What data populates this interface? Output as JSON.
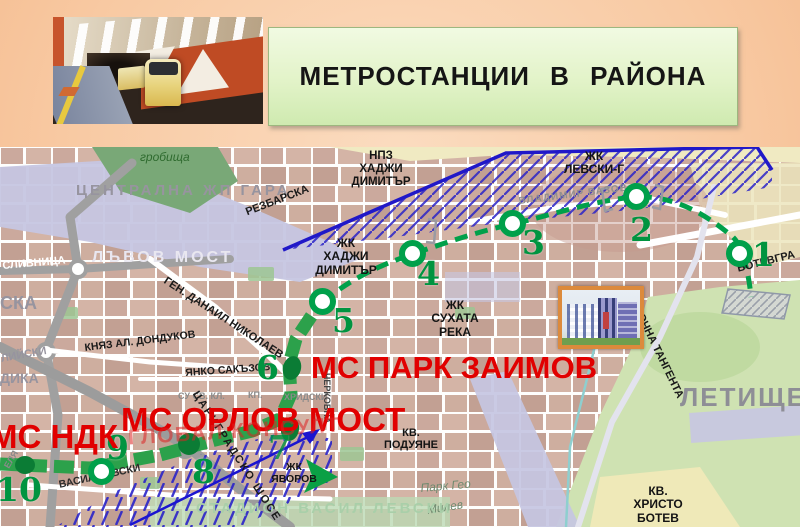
{
  "slide": {
    "title": "МЕТРОСТАНЦИИ  В  РАЙОНА"
  },
  "map": {
    "metro_labels": {
      "park_zaimov": "МС ПАРК ЗАИМОВ",
      "orlov_most": "МС ОРЛОВ МОСТ",
      "ndk": "МС НДК"
    },
    "watermark": "ГЛОБАЛ КОНСУЛТ",
    "metro_stations": [
      {
        "number": "1"
      },
      {
        "number": "2"
      },
      {
        "number": "3"
      },
      {
        "number": "4"
      },
      {
        "number": "5"
      },
      {
        "number": "6"
      },
      {
        "number": "7"
      },
      {
        "number": "8"
      },
      {
        "number": "9"
      },
      {
        "number": "10"
      }
    ],
    "districts": {
      "npz_hadzhi_dimitar": "НПЗ\nХАДЖИ\nДИМИТЪР",
      "zhk_hadzhi_dimitar": "ЖК\nХАДЖИ\nДИМИТЪР",
      "zhk_levski_g": "ЖК\nЛЕВСКИ-Г",
      "zhk_suhata_reka": "ЖК\nСУХАТА\nРЕКА",
      "kv_poduyane": "КВ.\nПОДУЯНЕ",
      "kv_hristo_botev": "КВ.\nХРИСТО\nБОТЕВ",
      "zhk_yavorov": "ЖК\nЯВОРОВ",
      "letishte": "ЛЕТИЩЕ",
      "grobishta": "гробища",
      "tsentralna_gara": "ЦЕНТРАЛНА ЖП ГАРА",
      "lavov_most": "ЛЪВОВ МОСТ",
      "stadion": "СТАДИОН ВАСИЛ ЛЕВСКИ",
      "park_geo": "Парк Гео",
      "milev": "Милев",
      "ska": "СКА",
      "dika": "ДИКА",
      "liyski": "ЛИЙСКИ",
      "su_sv_kl": "СУ СВ. КЛ.",
      "hridski": "ХРИДСКИ",
      "kp": "КП."
    },
    "streets": {
      "slivnitsa": "СЛИВНИЦА",
      "rezbarska": "РЕЗБАРСКА",
      "gen_danail_nikolaev": "ГЕН. ДАНАИЛ НИКОЛАЕВ",
      "knyaz_al_dondukov": "КНЯЗ АЛ. ДОНДУКОВ",
      "yanko_sakazov": "ЯНКО САКЪЗОВ",
      "vasil_levski": "ВАСИЛ ЛЕВСКИ",
      "tsarigradsko_shose": "ЦАРИГРАДСКО ШОСЕ",
      "iztochna_tangenta": "ИЗТОЧНА ТАНГЕНТА",
      "botevgradsko": "БОТЕВГРА",
      "cherkovna": "ЧЕРКОВНА",
      "vladimir_vazov": "ВЛАДИМИР ВАЗОВ",
      "elya": "ЕЛЯ"
    },
    "colors": {
      "metro_green": "#00a04a",
      "label_red": "#e10000",
      "hatch_blue": "#2a23c8",
      "header_peach": "#f8c9a2",
      "title_panel_green": "#ddf2c2"
    }
  }
}
